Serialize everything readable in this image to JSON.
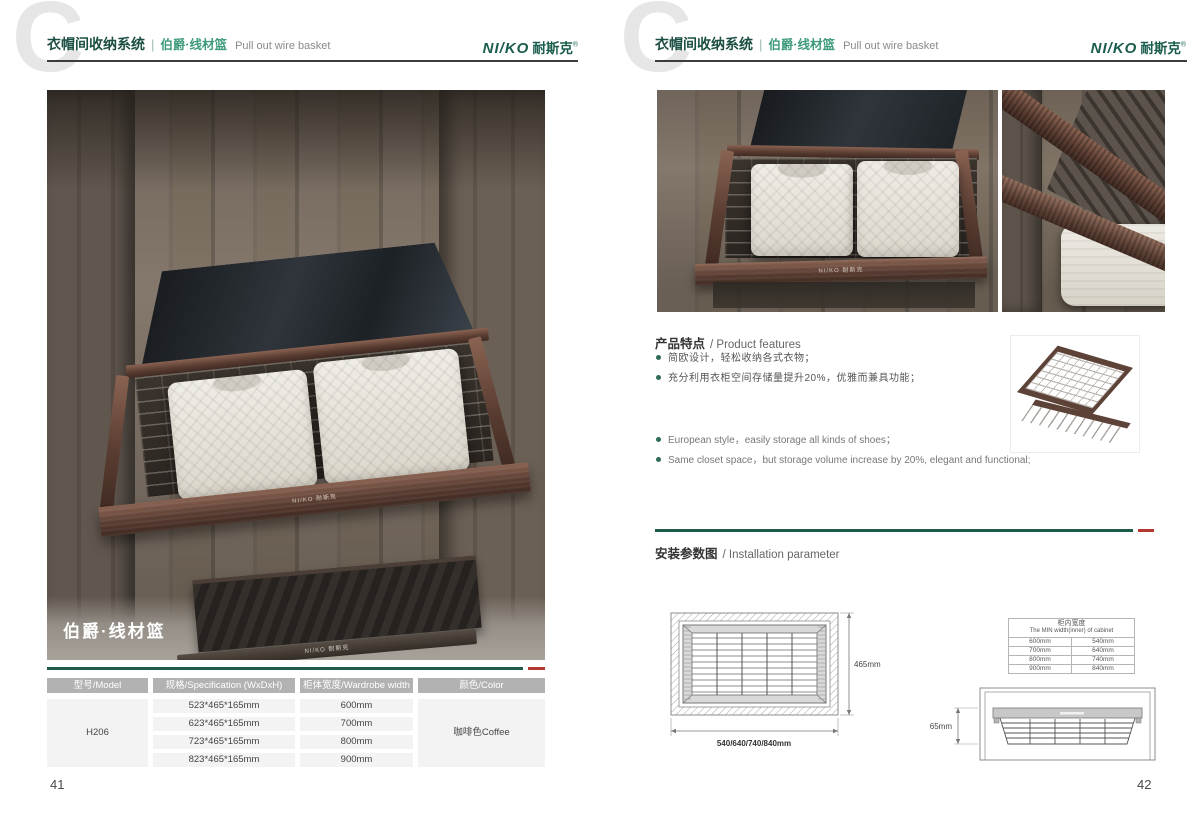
{
  "colors": {
    "green_dark": "#1a5c4e",
    "green_mid": "#3f9b7d",
    "red": "#b5392f",
    "bronze": "#5a3d32"
  },
  "header": {
    "watermark": "C",
    "title_zh": "衣帽间收纳系统",
    "divider": "|",
    "product_zh": "伯爵·线材篮",
    "product_en": "Pull out wire basket"
  },
  "brand": {
    "latin": "NI/KO",
    "cn": "耐斯克",
    "reg": "®",
    "rail_label": "NI/KO 耐斯克"
  },
  "left": {
    "caption": "伯爵·线材篮",
    "table": {
      "headers": {
        "model": "型号/Model",
        "spec": "规格/Specification (WxDxH)",
        "width": "柜体宽度/Wardrobe width",
        "color": "颜色/Color"
      },
      "model": "H206",
      "rows": [
        {
          "spec": "523*465*165mm",
          "width": "600mm"
        },
        {
          "spec": "623*465*165mm",
          "width": "700mm"
        },
        {
          "spec": "723*465*165mm",
          "width": "800mm"
        },
        {
          "spec": "823*465*165mm",
          "width": "900mm"
        }
      ],
      "color": "咖啡色Coffee"
    },
    "page_no": "41"
  },
  "right": {
    "features": {
      "title_zh": "产品特点",
      "title_en": "/ Product features",
      "zh": [
        "简欧设计，轻松收纳各式衣物；",
        "充分利用衣柜空间存储量提升20%，优雅而兼具功能；"
      ],
      "en": [
        "European style，easily storage all kinds of shoes；",
        "Same closet space，but storage volume increase by 20%, elegant and functional;"
      ]
    },
    "install": {
      "title_zh": "安装参数图",
      "title_en": "/ Installation parameter",
      "top_view": {
        "depth": "465mm",
        "width": "540/640/740/840mm"
      },
      "side_view": {
        "height": "165mm"
      },
      "table": {
        "title_zh": "柜内宽度",
        "title_en": "The MIN width(inner) of cabinet",
        "rows": [
          [
            "600mm",
            "540mm"
          ],
          [
            "700mm",
            "640mm"
          ],
          [
            "800mm",
            "740mm"
          ],
          [
            "900mm",
            "840mm"
          ]
        ]
      }
    },
    "page_no": "42"
  }
}
